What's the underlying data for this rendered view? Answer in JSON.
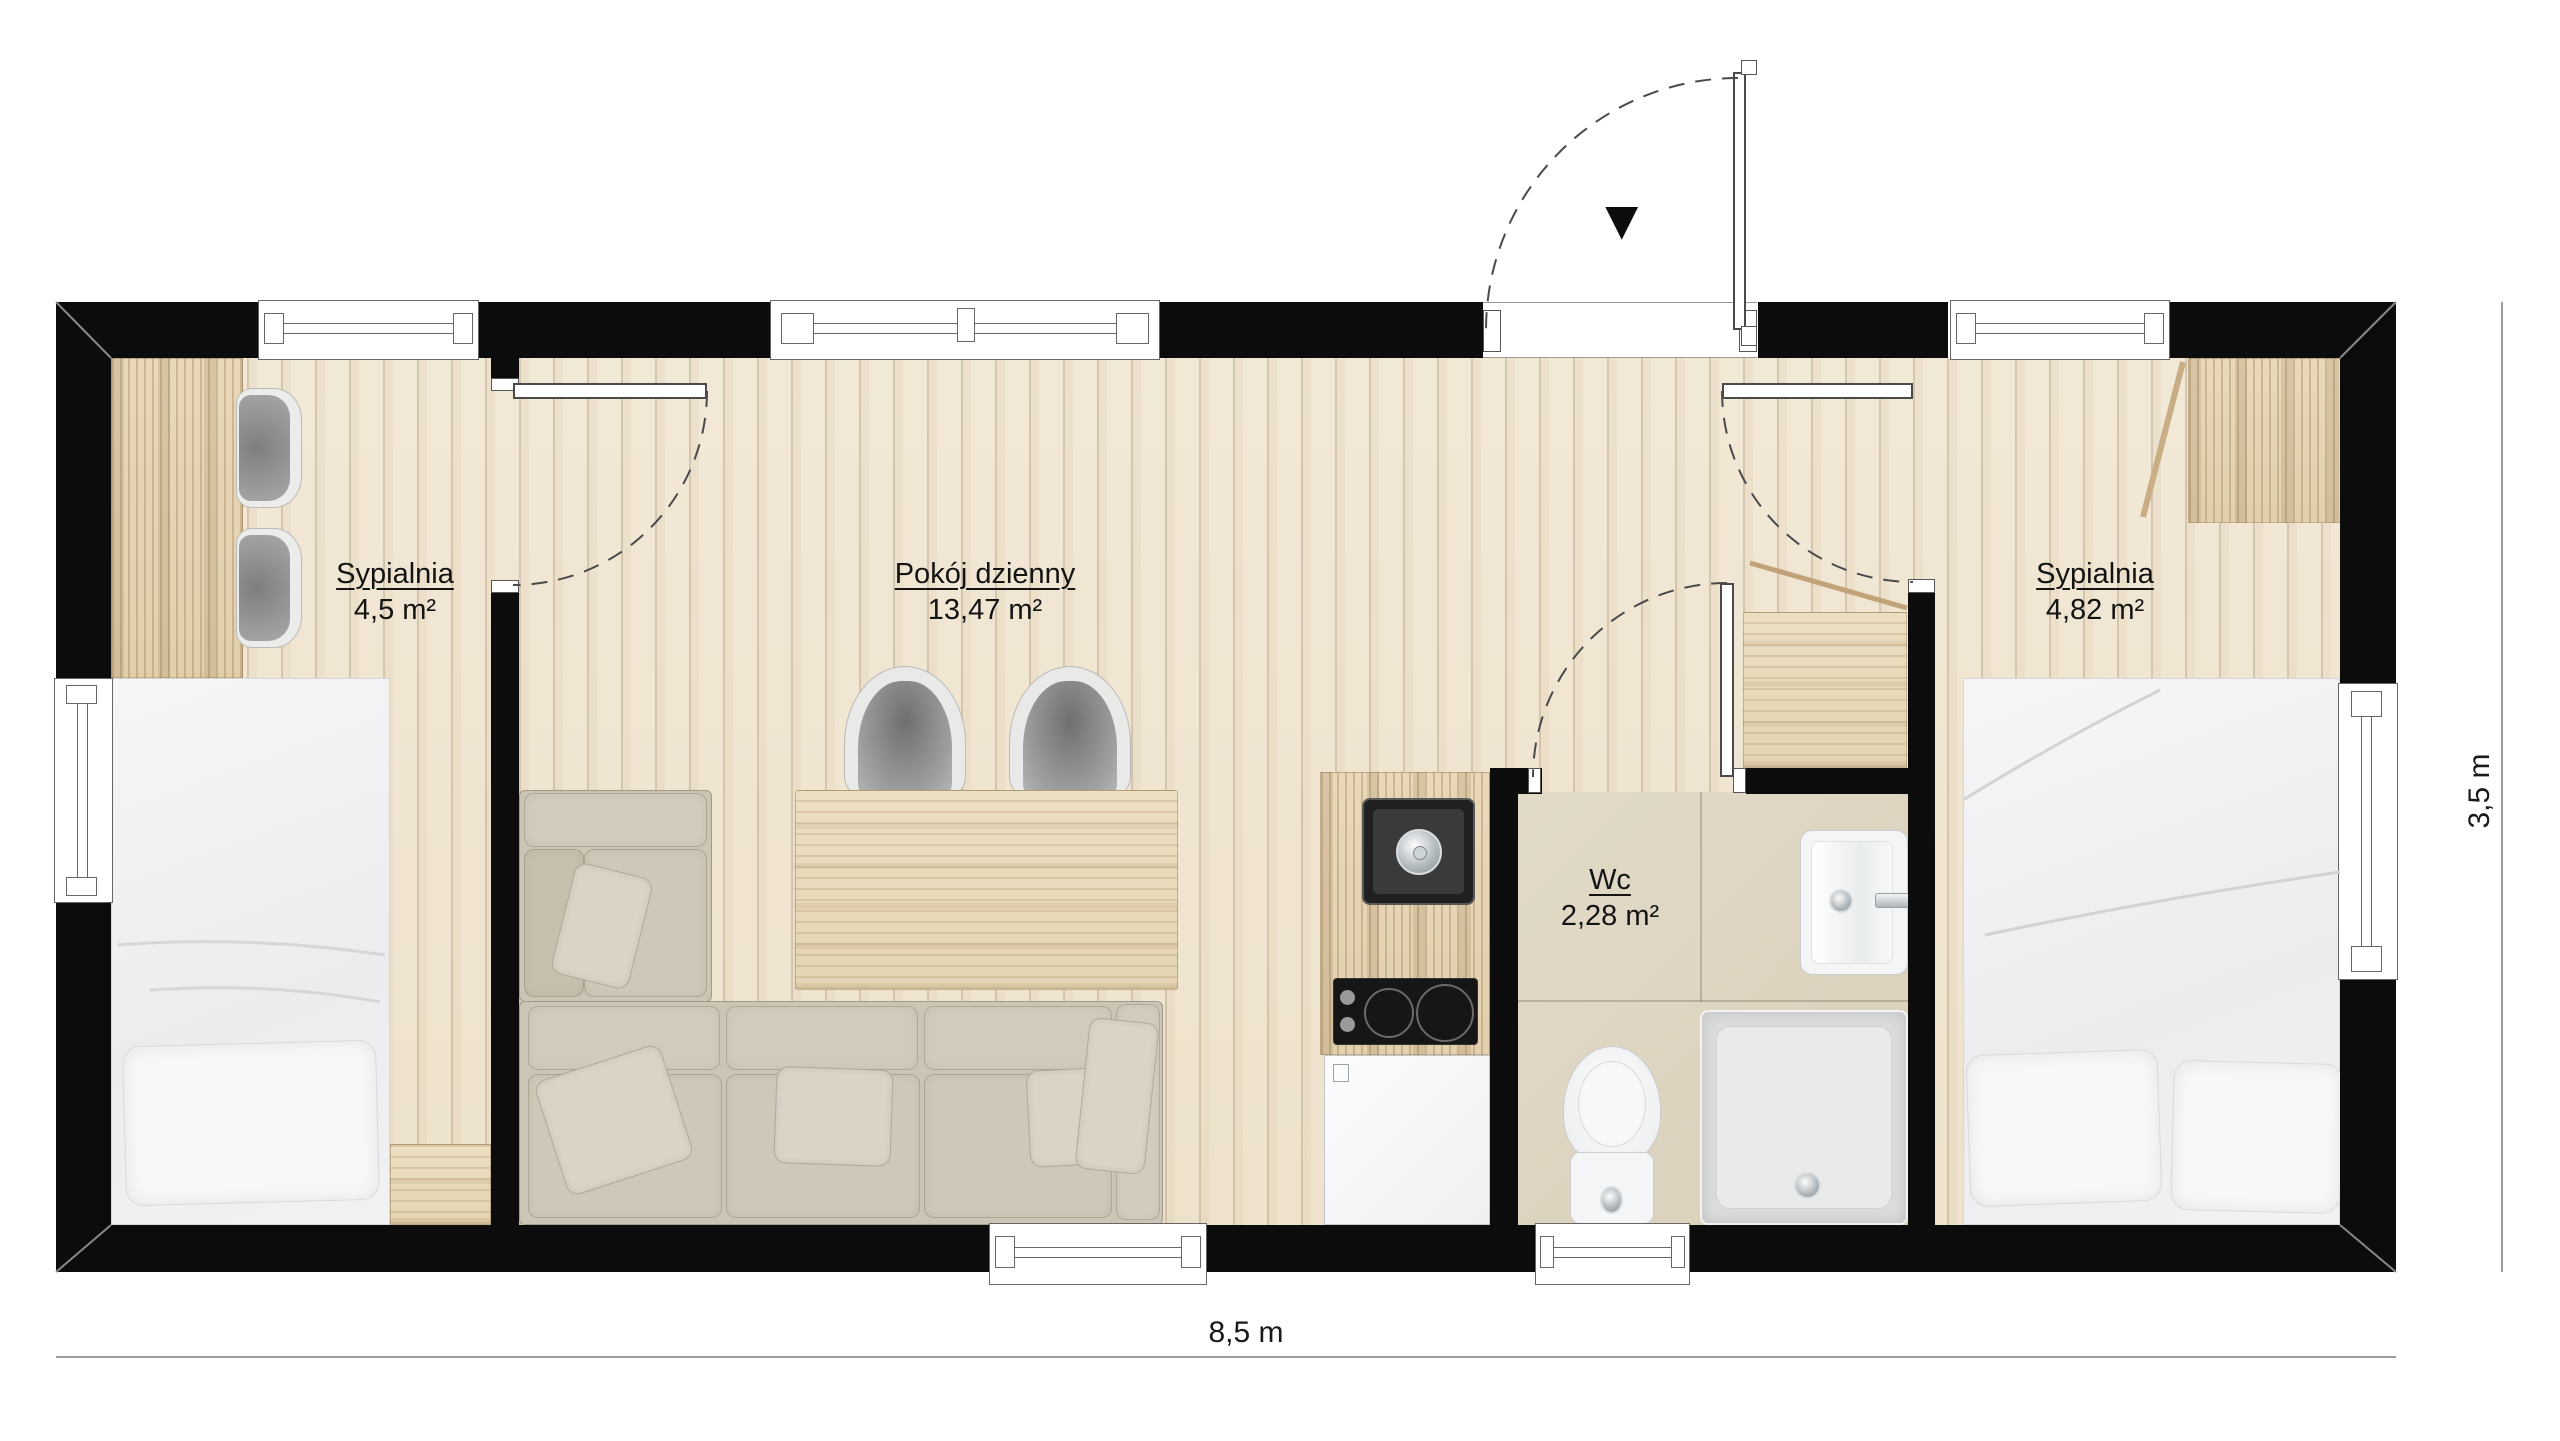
{
  "document": {
    "type": "floor-plan",
    "language": "pl"
  },
  "rooms": {
    "bedroom_left": {
      "name": "Sypialnia",
      "area": "4,5 m²"
    },
    "living_room": {
      "name": "Pokój dzienny",
      "area": "13,47 m²"
    },
    "wc": {
      "name": "Wc",
      "area": "2,28 m²"
    },
    "bedroom_right": {
      "name": "Sypialnia",
      "area": "4,82 m²"
    }
  },
  "dimensions": {
    "overall_width": "8,5 m",
    "overall_height": "3,5 m"
  },
  "icons": {
    "entrance_arrow_icon": "▼"
  },
  "colors": {
    "wall": "#0c0c0c",
    "floor_wood": "#f0e5d2",
    "plank_line": "#c7b89f",
    "wc_tile": "#ded5c2",
    "furniture_wood": "#e6d5b6",
    "sofa": "#cdc5b5",
    "appliance_dark": "#1d1d1d",
    "fixture_white": "#f6f6f6",
    "dimension_line": "#9b9b9b",
    "label_text": "#141414"
  }
}
